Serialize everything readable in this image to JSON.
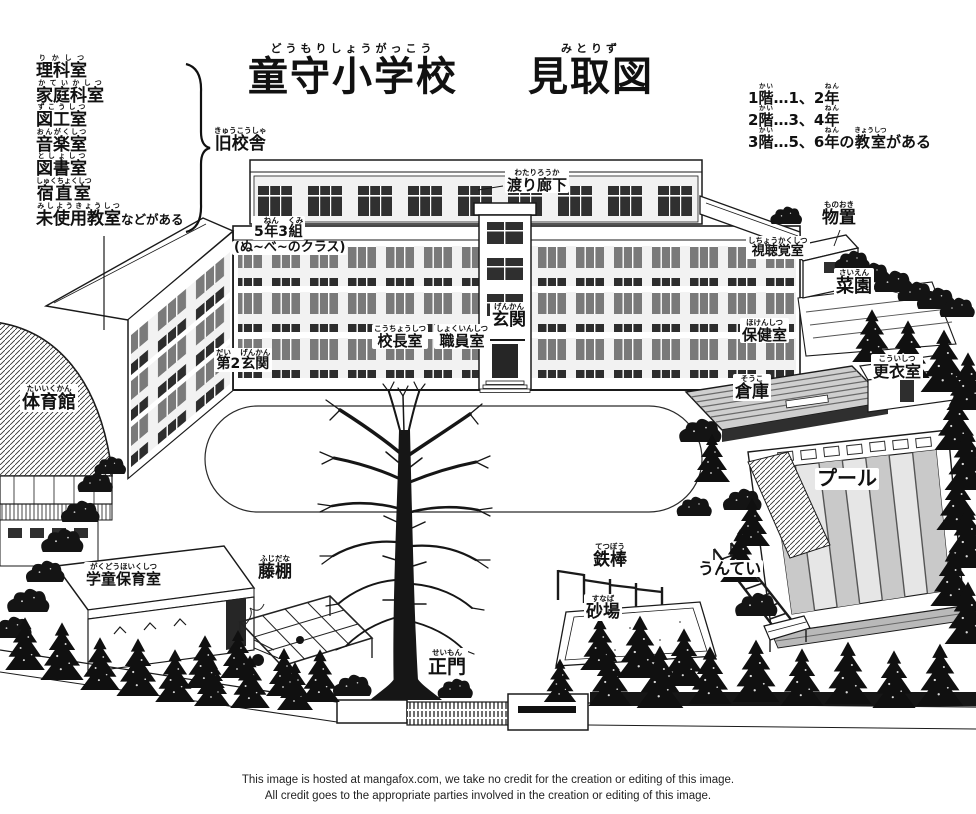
{
  "title": {
    "school": [
      [
        "童守小学校",
        "どうもりしょうがっこう"
      ]
    ],
    "map": [
      [
        "見取図",
        "みとりず"
      ]
    ]
  },
  "old_building": {
    "rooms": [
      [
        [
          "理科室",
          "りかしつ"
        ]
      ],
      [
        [
          "家庭科室",
          "かていかしつ"
        ]
      ],
      [
        [
          "図工室",
          "ずこうしつ"
        ]
      ],
      [
        [
          "音楽室",
          "おんがくしつ"
        ]
      ],
      [
        [
          "図書室",
          "としょしつ"
        ]
      ],
      [
        [
          "宿直室",
          "しゅくちょくしつ"
        ]
      ],
      [
        [
          "未使用教室",
          "みしようきょうしつ"
        ],
        [
          "などがある",
          ""
        ]
      ]
    ],
    "name": [
      [
        "旧校舎",
        "きゅうこうしゃ"
      ]
    ]
  },
  "floor_legend": {
    "lines": [
      [
        [
          "1",
          ""
        ],
        [
          "階",
          "かい"
        ],
        [
          "…1、2",
          ""
        ],
        [
          "年",
          "ねん"
        ]
      ],
      [
        [
          "2",
          ""
        ],
        [
          "階",
          "かい"
        ],
        [
          "…3、4",
          ""
        ],
        [
          "年",
          "ねん"
        ]
      ],
      [
        [
          "3",
          ""
        ],
        [
          "階",
          "かい"
        ],
        [
          "…5、6",
          ""
        ],
        [
          "年",
          "ねん"
        ],
        [
          "の",
          ""
        ],
        [
          "教室",
          "きょうしつ"
        ],
        [
          "がある",
          ""
        ]
      ]
    ]
  },
  "labels": {
    "watari_roka": [
      [
        "渡り廊下",
        "わたりろうか"
      ]
    ],
    "monooki": [
      [
        "物置",
        "ものおき"
      ]
    ],
    "shichokaku": [
      [
        "視聴覚室",
        "しちょうかくしつ"
      ]
    ],
    "saien": [
      [
        "菜園",
        "さいえん"
      ]
    ],
    "hoken": [
      [
        "保健室",
        "ほけんしつ"
      ]
    ],
    "genkan": [
      [
        "玄関",
        "げんかん"
      ]
    ],
    "kocho": [
      [
        "校長室",
        "こうちょうしつ"
      ]
    ],
    "shokuin": [
      [
        "職員室",
        "しょくいんしつ"
      ]
    ],
    "dai2genkan": [
      [
        "第",
        "だい"
      ],
      [
        "2",
        ""
      ],
      [
        "玄関",
        "げんかん"
      ]
    ],
    "class53": [
      [
        "5",
        ""
      ],
      [
        "年",
        "ねん"
      ],
      [
        "3",
        ""
      ],
      [
        "組",
        "くみ"
      ]
    ],
    "class53_line2": "(ぬ~べ~のクラス)",
    "taiikukan": [
      [
        "体育館",
        "たいいくかん"
      ]
    ],
    "soko": [
      [
        "倉庫",
        "そうこ"
      ]
    ],
    "koishitsu": [
      [
        "更衣室",
        "こういしつ"
      ]
    ],
    "pool": [
      [
        "プール",
        ""
      ]
    ],
    "gakudo": [
      [
        "学童保育室",
        "がくどうほいくしつ"
      ]
    ],
    "fujidana": [
      [
        "藤棚",
        "ふじだな"
      ]
    ],
    "tetsubo": [
      [
        "鉄棒",
        "てつぼう"
      ]
    ],
    "sunaba": [
      [
        "砂場",
        "すなば"
      ]
    ],
    "untei": [
      [
        "うんてい",
        ""
      ]
    ],
    "seimon": [
      [
        "正門",
        "せいもん"
      ]
    ]
  },
  "credit": {
    "line1": "This image is hosted at mangafox.com, we take no credit for the creation or editing of this image.",
    "line2": "All credit goes to the appropriate parties involved in the creation or editing of this image."
  },
  "colors": {
    "ink": "#1a1a1a",
    "window_dark": "#2f2f2f",
    "window_mid": "#7a7a7a",
    "tree": "#101010",
    "paper": "#ffffff"
  }
}
